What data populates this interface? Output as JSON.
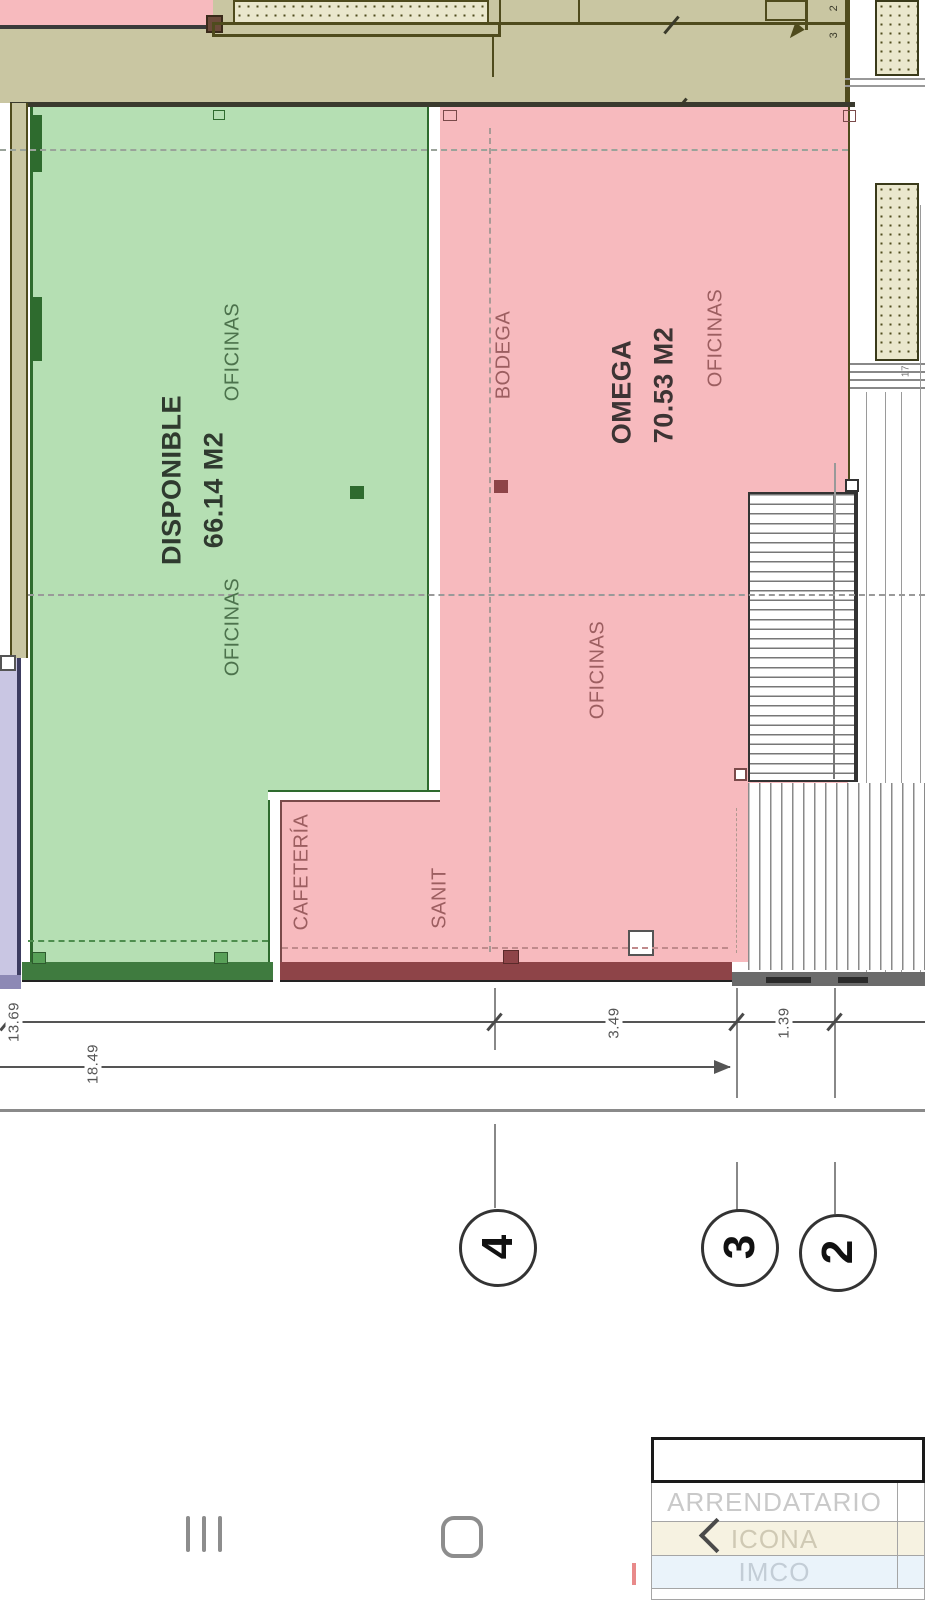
{
  "plan": {
    "green_unit": {
      "name": "DISPONIBLE",
      "area": "66.14 M2",
      "room_top": "OFICINAS",
      "room_bottom": "OFICINAS"
    },
    "pink_unit": {
      "name": "OMEGA",
      "area": "70.53 M2",
      "room_top": "OFICINAS",
      "room_mid": "OFICINAS",
      "bodega": "BODEGA",
      "sanit": "SANIT",
      "cafeteria": "CAFETERÍA"
    },
    "dimensions": {
      "left_partial": "13.69",
      "left_overall": "18.49",
      "bay_3_4": "3.49",
      "bay_2_3": "1.39",
      "top_small_a": "2",
      "top_small_b": "3",
      "right_small": "17"
    },
    "grid": {
      "b4": "4",
      "b3": "3",
      "b2": "2"
    }
  },
  "titleblock": {
    "rows": [
      {
        "label": "ARRENDATARIO"
      },
      {
        "label": "ICONA"
      },
      {
        "label": "IMCO"
      }
    ]
  },
  "navbar": {
    "recents_icon": "recents (三 rotated)",
    "home_icon": "home (squircle)",
    "back_icon": "back (chevron)"
  },
  "colors": {
    "green_fill": "#b5dfb3",
    "green_wall": "#3f7b3f",
    "pink_fill": "#f7babe",
    "red_wall": "#8e4448",
    "olive_fill": "#c9c6a2",
    "olive_line": "#4f4b1d",
    "purple_fill": "#c9c6e3",
    "nav_gray": "#8d8d8d"
  }
}
